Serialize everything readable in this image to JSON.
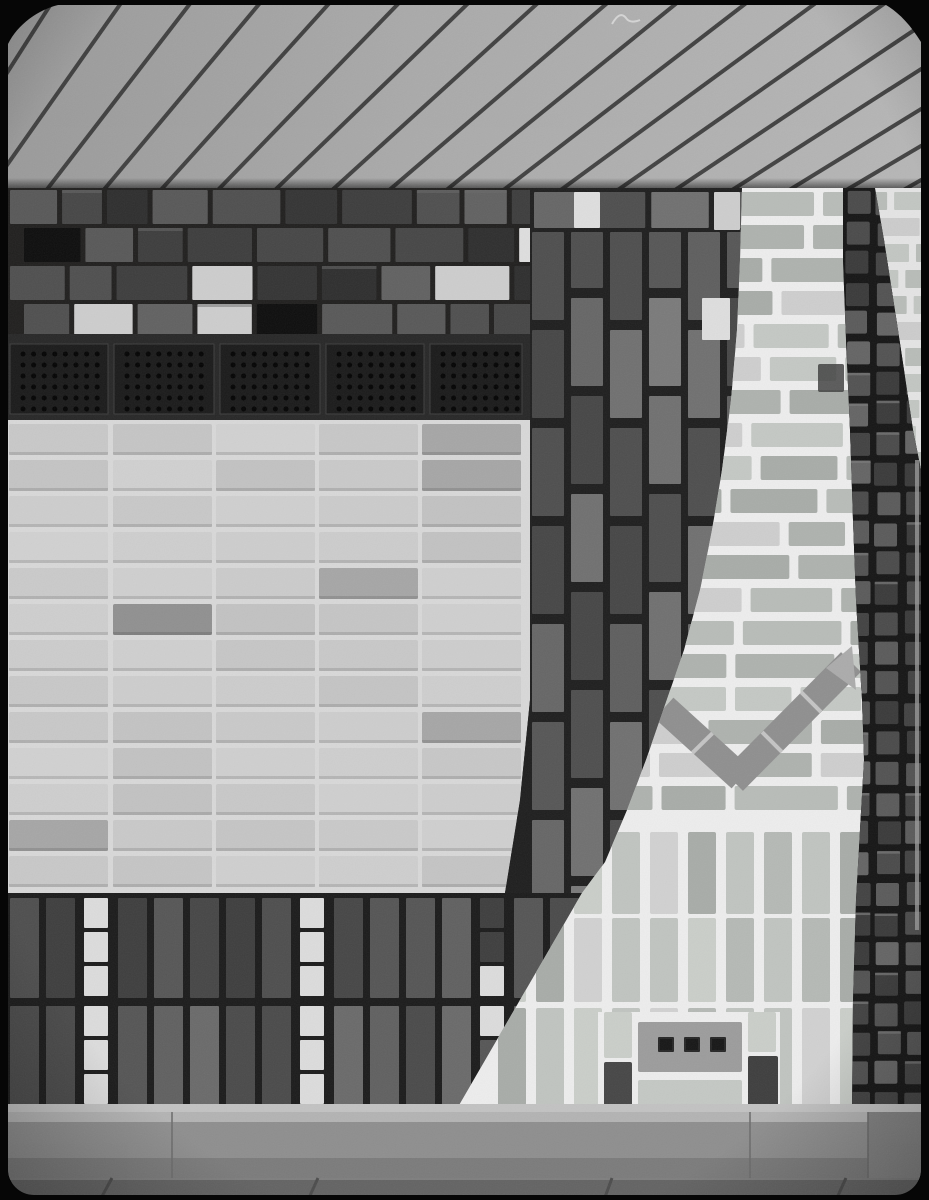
{
  "meta": {
    "kind": "black-and-white architectural photograph",
    "subject": "decorative-brick-wall-with-slatted-eave"
  },
  "photo": {
    "counts": {
      "ventilation_grilles": 5,
      "grille_dot_rows": 6,
      "grille_dot_cols": 8,
      "chevron_arms": 2,
      "perforated_brick_holes": 3,
      "white_accent_columns": 2
    },
    "regions": [
      {
        "id": "ceiling-slats",
        "label": "wooden slatted eave seen from below"
      },
      {
        "id": "upper-dark-brick-band",
        "label": "dark clinker band with scattered white bricks"
      },
      {
        "id": "ventilation-grille-row",
        "label": "row of perforated vent blocks"
      },
      {
        "id": "light-brick-field",
        "label": "large field of light stacked bricks"
      },
      {
        "id": "dark-brick-drape",
        "label": "curved dark brick band"
      },
      {
        "id": "right-light-brick-panel",
        "label": "light brick panel with chevron inlay"
      },
      {
        "id": "cobble-brick-column",
        "label": "column of small square dark bricks"
      },
      {
        "id": "bottom-dark-brick-band",
        "label": "dark soldier-course base band with white accents"
      },
      {
        "id": "concrete-curb",
        "label": "concrete curb"
      },
      {
        "id": "pavement",
        "label": "stone pavement"
      },
      {
        "id": "film-frame-border",
        "label": "black film plate border"
      }
    ],
    "palette": {
      "frame": "#060606",
      "slatGradA": "#9a9a9a",
      "slatGradB": "#aaaaaa",
      "slatGradC": "#b6b6b6",
      "slatGap": "#383838",
      "scratch": "#e0e0e0",
      "upperMortar": "#201f1e",
      "upperBricks": [
        "#343434",
        "#3d3d3d",
        "#464646",
        "#4f4f4f",
        "#585858",
        "#616161",
        "#2e2e2e"
      ],
      "whiteBrick": "#dedede",
      "whiteBrick2": "#cdcdcd",
      "recess": "#0d0d0d",
      "grilleMortar": "#272727",
      "grilleFace": "#1a1a1a",
      "grilleEdge": "#3e3e3e",
      "grilleDot": "#030303",
      "fieldMortar": "#d8d8d8",
      "fieldBrickBase": "#c9c9c9",
      "fieldBrickDark": "#a6a6a6",
      "fieldBrickDarker": "#909090",
      "drapeMortar": "#1e1e1e",
      "drapeBricks": [
        "#464646",
        "#4e4e4e",
        "#565656",
        "#5e5e5e",
        "#666666",
        "#707070"
      ],
      "panelMortar": "#ededed",
      "panelBricks": [
        "#b8bcb8",
        "#c4c8c4",
        "#aeb2ae",
        "#cecece",
        "#a8aca8"
      ],
      "panelDarkBrick": "#3f3f3f",
      "chevron": "#8f8f8f",
      "chevronJoint": "#c4c4c4",
      "chevronCap": "#ababab",
      "soldierBricks": [
        "#c0c4c0",
        "#cacec9",
        "#b5b9b5",
        "#d1d1d1"
      ],
      "holedBrick": "#9c9c9c",
      "hole": "#262626",
      "accentDark1": "#464646",
      "accentDark2": "#3e3e3e",
      "cobbleBg": "#151515",
      "cobbles": [
        "#3a3a3a",
        "#424242",
        "#4a4a4a",
        "#525252",
        "#5a5a5a",
        "#646464"
      ],
      "cobbleHi": "#787878",
      "bandMortar": "#1b1b1b",
      "bandBricks": [
        "#3e3e3e",
        "#464646",
        "#4e4e4e",
        "#565656"
      ],
      "bandBricks2": [
        "#4a4a4a",
        "#555555",
        "#606060",
        "#6a6a6a"
      ],
      "accentWhite": "#dcdcdc",
      "sliverMortar": "#e4e4e4",
      "sliverBricks": [
        "#c2c6c2",
        "#cccccc",
        "#b8bcb8"
      ],
      "mortarLine": "#c2c2c2",
      "curb": "#8e8e8e",
      "curbTop": "#b3b3b3",
      "curbShade": "#7b7b7b",
      "curbJoint": "#6e6e6e",
      "curbDarkPatch": "#828282",
      "pavement": "#636363",
      "pavementJoint": "#4c4c4c",
      "pavementLip": "#7e7e7e",
      "glint": "#9e9e9e"
    }
  }
}
